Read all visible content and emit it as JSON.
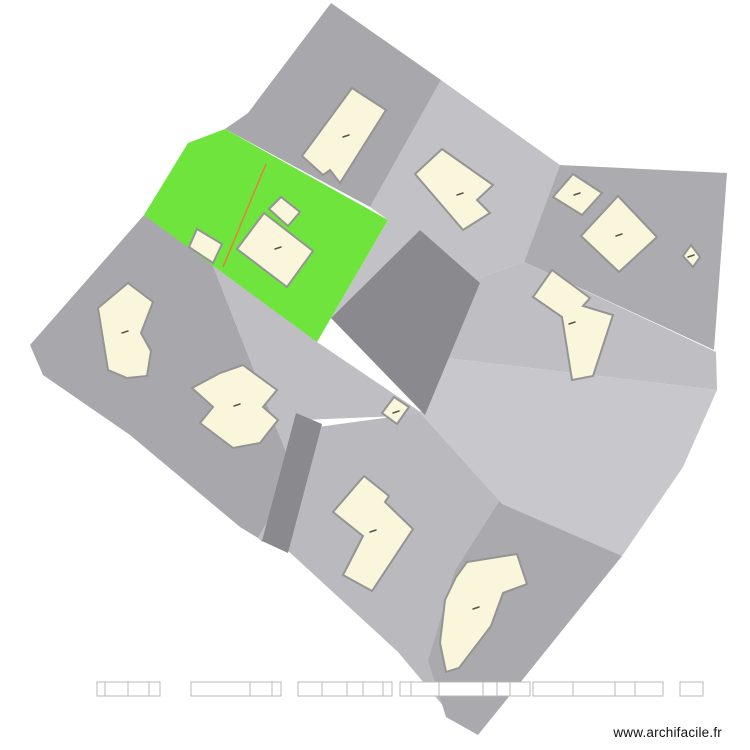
{
  "watermark": {
    "text": "www.archifacile.fr"
  },
  "colors": {
    "background": "#ffffff",
    "parcel_dark": "#8a8a8e",
    "parcel_medium": "#a8a8ac",
    "parcel_medium2": "#acacb0",
    "parcel_light": "#c2c2c6",
    "parcel_lighter": "#c8c8cc",
    "parcel_mid_light": "#bfbfc3",
    "parcel_bottom_mid": "#bababe",
    "parcel_bottom_right": "#aaaaae",
    "parcel_green": "#6fe43c",
    "divider_orange": "#e2813c",
    "building_fill": "#faf6dc",
    "building_stroke": "#949494",
    "mark_color": "#55554a",
    "scalebar_fill": "#ffffff",
    "scalebar_stroke": "#b8b8b8"
  },
  "map": {
    "width": 750,
    "height": 750,
    "parcels": [
      {
        "name": "parcel-left",
        "fill": "#a8a8ac",
        "points": [
          [
            144,
            215
          ],
          [
            210,
            258
          ],
          [
            295,
            475
          ],
          [
            258,
            538
          ],
          [
            240,
            527
          ],
          [
            130,
            435
          ],
          [
            43,
            375
          ],
          [
            30,
            345
          ]
        ]
      },
      {
        "name": "parcel-center-left",
        "fill": "#bfbfc3",
        "points": [
          [
            210,
            258
          ],
          [
            317,
            342
          ],
          [
            425,
            415
          ],
          [
            302,
            420
          ],
          [
            262,
            542
          ],
          [
            258,
            538
          ],
          [
            295,
            475
          ]
        ]
      },
      {
        "name": "parcel-bottom-middle",
        "fill": "#bababe",
        "points": [
          [
            318,
            427
          ],
          [
            420,
            413
          ],
          [
            503,
            495
          ],
          [
            455,
            570
          ],
          [
            428,
            660
          ],
          [
            455,
            720
          ],
          [
            398,
            652
          ],
          [
            285,
            548
          ]
        ]
      },
      {
        "name": "parcel-bottom-right",
        "fill": "#aaaaae",
        "points": [
          [
            503,
            495
          ],
          [
            622,
            556
          ],
          [
            478,
            735
          ],
          [
            446,
            717
          ],
          [
            428,
            660
          ],
          [
            455,
            570
          ]
        ]
      },
      {
        "name": "parcel-top-right",
        "fill": "#c2c2c6",
        "points": [
          [
            441,
            80
          ],
          [
            560,
            165
          ],
          [
            524,
            262
          ],
          [
            473,
            280
          ],
          [
            420,
            230
          ],
          [
            331,
            318
          ],
          [
            388,
            220
          ],
          [
            370,
            207
          ]
        ]
      },
      {
        "name": "parcel-right",
        "fill": "#acacb0",
        "points": [
          [
            560,
            165
          ],
          [
            727,
            173
          ],
          [
            714,
            350
          ],
          [
            524,
            262
          ]
        ]
      },
      {
        "name": "parcel-strip-upper",
        "fill": "#bfbfc3",
        "points": [
          [
            524,
            262
          ],
          [
            716,
            352
          ],
          [
            717,
            390
          ],
          [
            446,
            358
          ],
          [
            473,
            280
          ]
        ]
      },
      {
        "name": "parcel-strip-lower",
        "fill": "#c8c8cc",
        "points": [
          [
            446,
            358
          ],
          [
            717,
            390
          ],
          [
            683,
            467
          ],
          [
            622,
            556
          ],
          [
            502,
            504
          ],
          [
            420,
            413
          ]
        ]
      },
      {
        "name": "parcel-top",
        "fill": "#a8a8ac",
        "points": [
          [
            331,
            3
          ],
          [
            441,
            80
          ],
          [
            370,
            207
          ],
          [
            225,
            129
          ],
          [
            248,
            113
          ]
        ]
      },
      {
        "name": "parcel-center-dark",
        "fill": "#8a8a8e",
        "points": [
          [
            420,
            230
          ],
          [
            480,
            283
          ],
          [
            425,
            415
          ],
          [
            331,
            318
          ]
        ]
      },
      {
        "name": "road-strip",
        "fill": "#8a8a8e",
        "points": [
          [
            296,
            413
          ],
          [
            322,
            424
          ],
          [
            288,
            553
          ],
          [
            262,
            541
          ]
        ]
      },
      {
        "name": "parcel-green",
        "fill": "#6fe43c",
        "points": [
          [
            225,
            129
          ],
          [
            388,
            220
          ],
          [
            317,
            342
          ],
          [
            144,
            215
          ],
          [
            188,
            143
          ]
        ]
      }
    ],
    "divider": {
      "name": "parcel-divider-line",
      "x1": 266,
      "y1": 164,
      "x2": 223,
      "y2": 267,
      "stroke": "#e2813c",
      "width": 1.5
    },
    "buildings": [
      {
        "name": "building-top-rectangle",
        "points": [
          [
            352,
            88
          ],
          [
            386,
            110
          ],
          [
            340,
            183
          ],
          [
            330,
            170
          ],
          [
            323,
            175
          ],
          [
            302,
            156
          ]
        ]
      },
      {
        "name": "building-topright-notched",
        "points": [
          [
            442,
            149
          ],
          [
            493,
            185
          ],
          [
            477,
            200
          ],
          [
            490,
            213
          ],
          [
            463,
            230
          ],
          [
            415,
            174
          ]
        ]
      },
      {
        "name": "building-right-small",
        "points": [
          [
            573,
            174
          ],
          [
            602,
            193
          ],
          [
            582,
            215
          ],
          [
            553,
            197
          ]
        ]
      },
      {
        "name": "building-right-large",
        "points": [
          [
            618,
            196
          ],
          [
            657,
            237
          ],
          [
            619,
            272
          ],
          [
            581,
            236
          ]
        ]
      },
      {
        "name": "building-right-tiny",
        "points": [
          [
            691,
            245
          ],
          [
            700,
            257
          ],
          [
            693,
            267
          ],
          [
            683,
            256
          ]
        ]
      },
      {
        "name": "building-green-small",
        "points": [
          [
            197,
            229
          ],
          [
            222,
            244
          ],
          [
            213,
            263
          ],
          [
            189,
            247
          ]
        ]
      },
      {
        "name": "building-green-annex",
        "points": [
          [
            269,
            209
          ],
          [
            281,
            197
          ],
          [
            300,
            212
          ],
          [
            288,
            226
          ]
        ]
      },
      {
        "name": "building-green-main",
        "points": [
          [
            237,
            249
          ],
          [
            264,
            213
          ],
          [
            313,
            251
          ],
          [
            287,
            287
          ]
        ]
      },
      {
        "name": "building-left-pentagon",
        "points": [
          [
            128,
            283
          ],
          [
            153,
            302
          ],
          [
            141,
            333
          ],
          [
            151,
            351
          ],
          [
            147,
            376
          ],
          [
            127,
            378
          ],
          [
            108,
            370
          ],
          [
            98,
            308
          ]
        ]
      },
      {
        "name": "building-cross",
        "points": [
          [
            243,
            365
          ],
          [
            277,
            390
          ],
          [
            263,
            407
          ],
          [
            278,
            420
          ],
          [
            260,
            443
          ],
          [
            233,
            448
          ],
          [
            200,
            423
          ],
          [
            213,
            407
          ],
          [
            192,
            388
          ],
          [
            220,
            373
          ]
        ]
      },
      {
        "name": "building-seven-shape",
        "points": [
          [
            552,
            270
          ],
          [
            590,
            298
          ],
          [
            583,
            306
          ],
          [
            613,
            315
          ],
          [
            593,
            376
          ],
          [
            572,
            380
          ],
          [
            562,
            317
          ],
          [
            533,
            297
          ]
        ]
      },
      {
        "name": "building-dark-small",
        "points": [
          [
            394,
            397
          ],
          [
            409,
            407
          ],
          [
            397,
            424
          ],
          [
            382,
            413
          ]
        ]
      },
      {
        "name": "building-chevron",
        "points": [
          [
            364,
            476
          ],
          [
            389,
            496
          ],
          [
            385,
            502
          ],
          [
            413,
            529
          ],
          [
            372,
            591
          ],
          [
            343,
            575
          ],
          [
            363,
            536
          ],
          [
            333,
            512
          ]
        ]
      },
      {
        "name": "building-banana",
        "points": [
          [
            517,
            554
          ],
          [
            527,
            584
          ],
          [
            503,
            593
          ],
          [
            491,
            626
          ],
          [
            459,
            668
          ],
          [
            446,
            672
          ],
          [
            440,
            643
          ],
          [
            445,
            600
          ],
          [
            456,
            577
          ],
          [
            467,
            562
          ]
        ]
      }
    ],
    "building_style": {
      "fill": "#faf6dc",
      "stroke": "#949494",
      "stroke_width": 2
    },
    "marks": [
      {
        "x": 346,
        "y": 136
      },
      {
        "x": 460,
        "y": 194
      },
      {
        "x": 577,
        "y": 194
      },
      {
        "x": 619,
        "y": 235
      },
      {
        "x": 691,
        "y": 256
      },
      {
        "x": 278,
        "y": 248
      },
      {
        "x": 125,
        "y": 332
      },
      {
        "x": 237,
        "y": 405
      },
      {
        "x": 572,
        "y": 323
      },
      {
        "x": 396,
        "y": 412
      },
      {
        "x": 373,
        "y": 531
      },
      {
        "x": 476,
        "y": 608
      }
    ],
    "mark_style": {
      "stroke": "#55554a",
      "width": 1.5,
      "half_len": 3
    },
    "scalebar": {
      "y": 682,
      "height": 14,
      "fill": "#ffffff",
      "stroke": "#b8b8b8",
      "segments": [
        [
          97,
          8
        ],
        [
          105,
          23
        ],
        [
          128,
          21
        ],
        [
          149,
          11
        ],
        [
          191,
          59
        ],
        [
          250,
          22
        ],
        [
          272,
          9
        ],
        [
          298,
          24
        ],
        [
          322,
          25
        ],
        [
          347,
          16
        ],
        [
          363,
          20
        ],
        [
          383,
          9
        ],
        [
          400,
          11
        ],
        [
          411,
          28
        ],
        [
          439,
          44
        ],
        [
          483,
          14
        ],
        [
          497,
          13
        ],
        [
          510,
          20
        ],
        [
          533,
          40
        ],
        [
          573,
          42
        ],
        [
          615,
          20
        ],
        [
          635,
          28
        ],
        [
          680,
          23
        ]
      ]
    }
  }
}
